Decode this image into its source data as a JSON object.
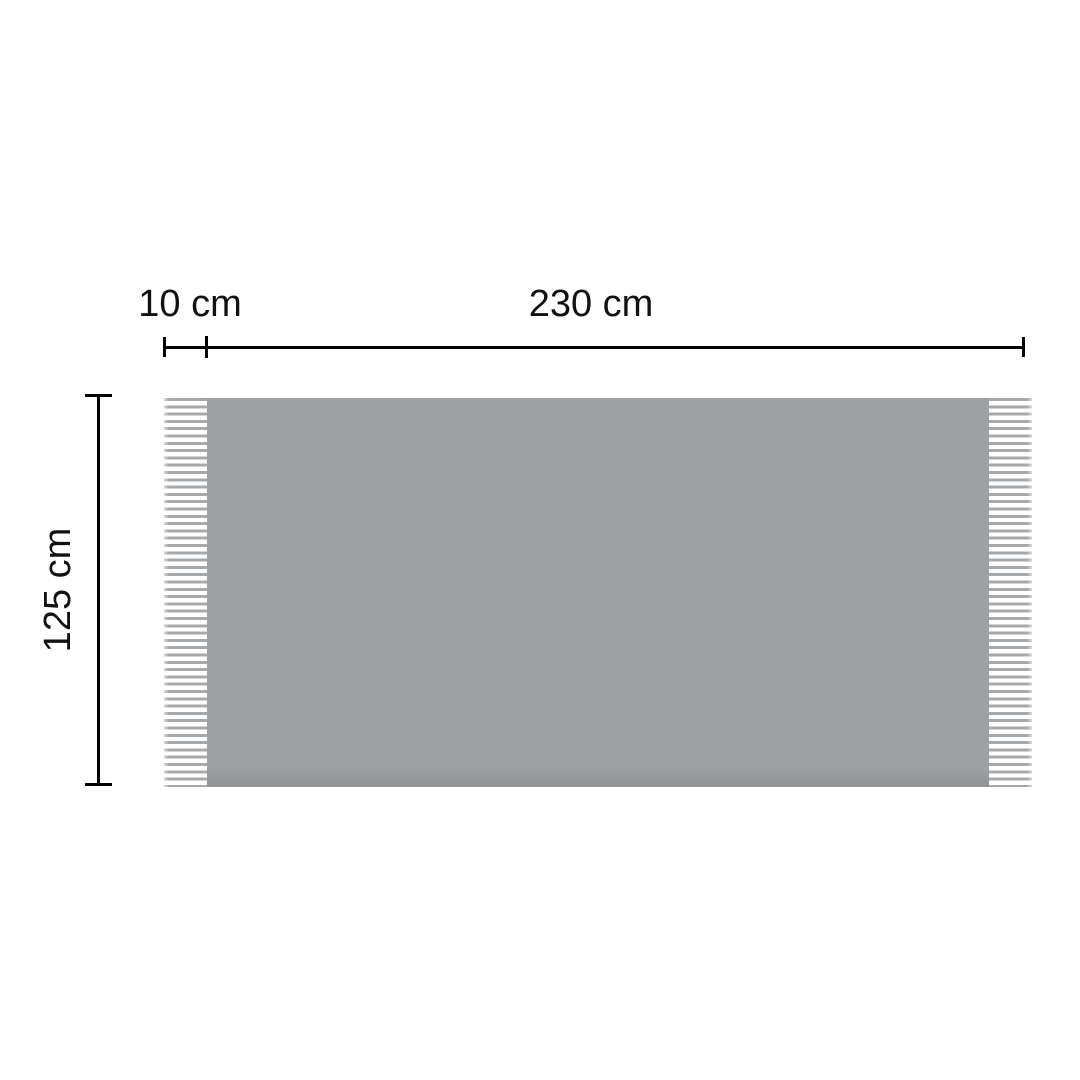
{
  "diagram": {
    "type": "product-dimension-diagram",
    "labels": {
      "fringe_width": "10 cm",
      "body_width": "230 cm",
      "height": "125 cm"
    },
    "colors": {
      "background": "#ffffff",
      "body": "#9da1a4",
      "body_edge": "#8f9396",
      "fringe": "#a5a9ab",
      "line": "#000000",
      "text": "#111111"
    }
  }
}
